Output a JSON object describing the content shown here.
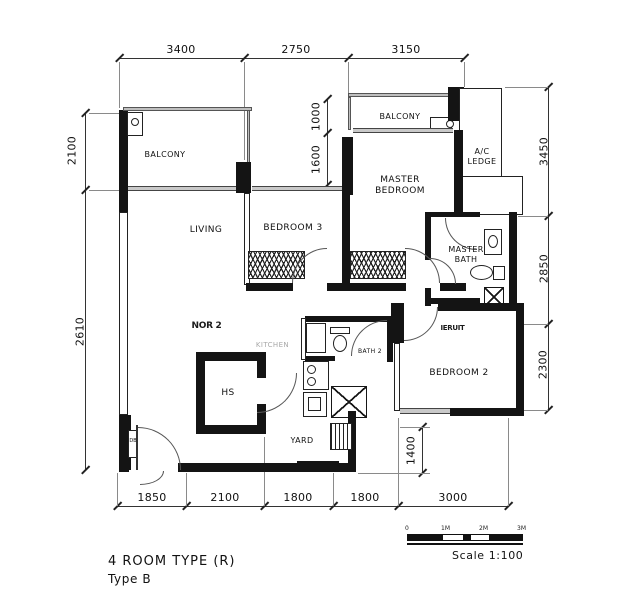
{
  "title": {
    "line1": "4 ROOM TYPE (R)",
    "line2": "Type B"
  },
  "scale_bar": {
    "label": "Scale 1:100",
    "ticks": [
      "0",
      "1M",
      "2M",
      "3M"
    ]
  },
  "rooms": {
    "balcony_left": "BALCONY",
    "balcony_top": "BALCONY",
    "living": "LIVING",
    "bedroom_3": "BEDROOM 3",
    "master_bedroom": "MASTER\nBEDROOM",
    "ac_ledge": "A/C\nLEDGE",
    "master_bath": "MASTER\nBATH",
    "bath_2": "BATH 2",
    "kitchen": "KITCHEN",
    "bedroom_2": "BEDROOM 2",
    "household_shelter": "HS",
    "yard": "YARD",
    "db": "DB"
  },
  "dimensions": {
    "top": [
      "3400",
      "2750",
      "3150"
    ],
    "left": [
      "2100",
      "2610"
    ],
    "right": [
      "3450",
      "2850",
      "2300"
    ],
    "bottom": [
      "1850",
      "2100",
      "1800",
      "1800",
      "3000"
    ],
    "inner": [
      "1000",
      "1600",
      "1400"
    ]
  },
  "artifacts": {
    "fragment_1": "NOR 2",
    "fragment_2": "IERUIT"
  }
}
